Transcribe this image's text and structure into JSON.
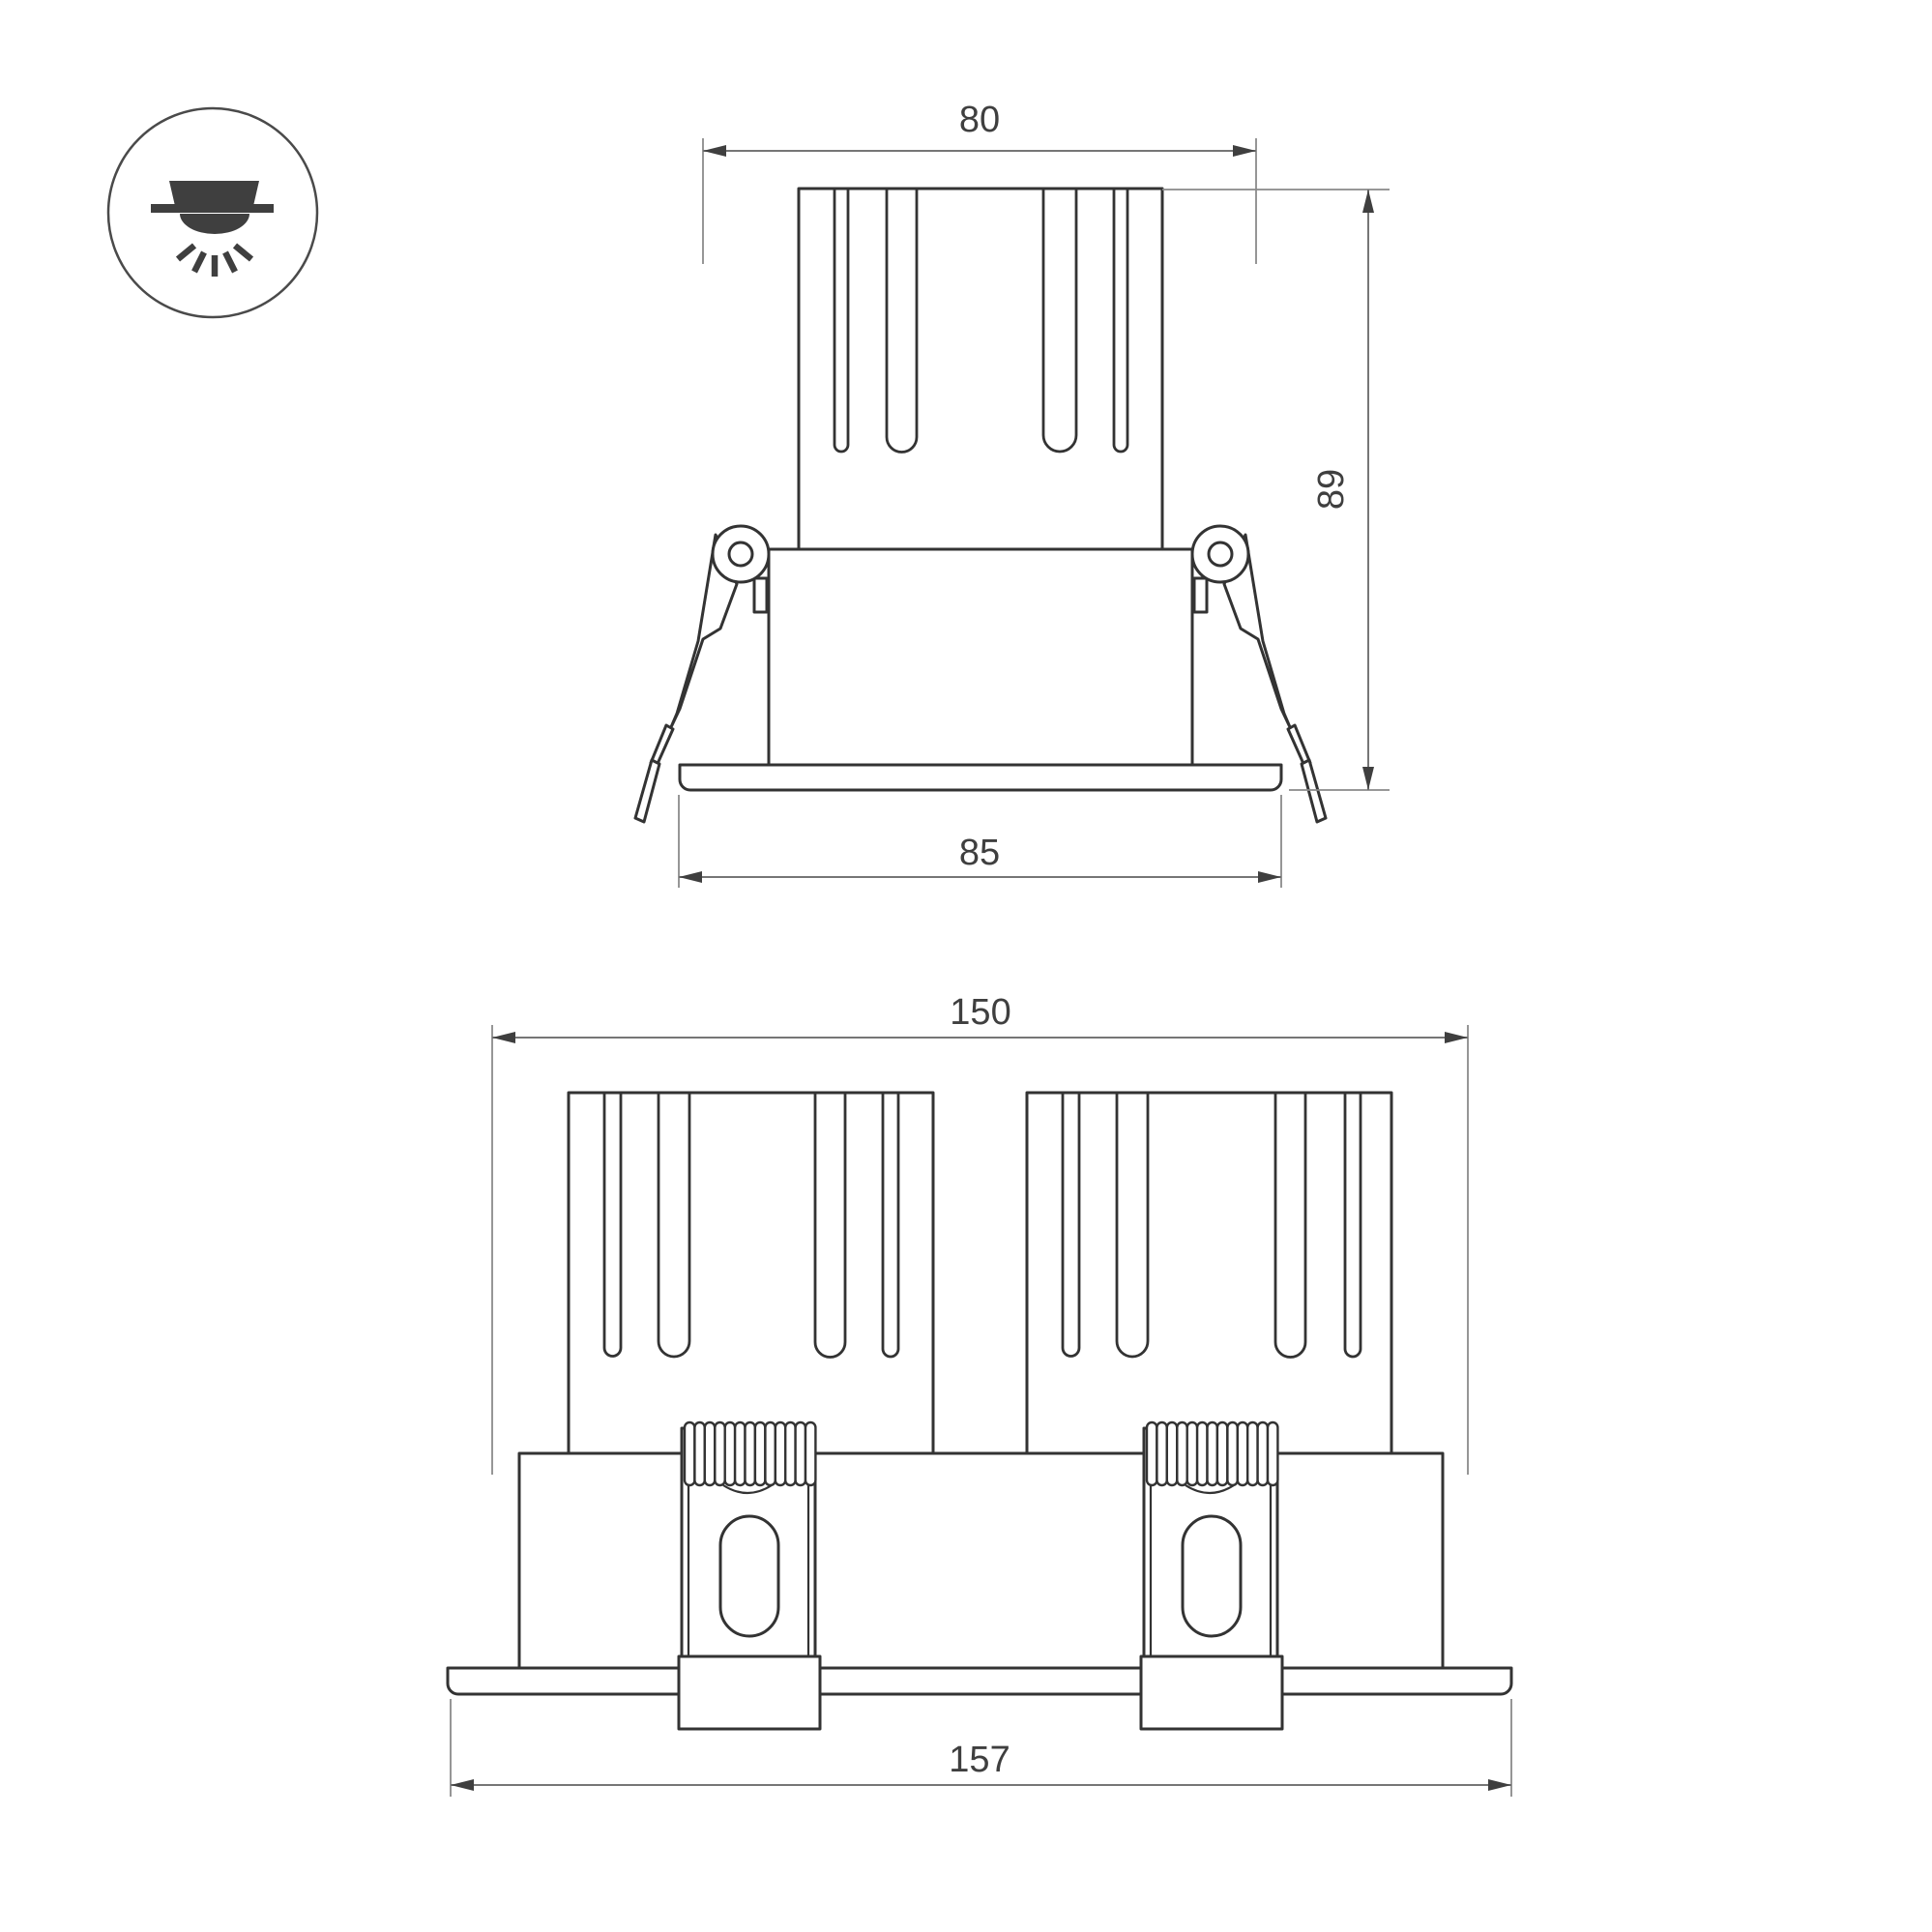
{
  "icon": {
    "name": "recessed-downlight-icon"
  },
  "views": {
    "single": {
      "dimensions": {
        "top_width": "80",
        "height": "89",
        "flange_width": "85"
      }
    },
    "double": {
      "dimensions": {
        "top_width": "150",
        "flange_width": "157"
      }
    }
  },
  "colors": {
    "part_line": "#333333",
    "dimension_line": "#767676",
    "dimension_text": "#3f3f3f",
    "icon_fill": "#3f3f3f",
    "background": "#ffffff"
  }
}
